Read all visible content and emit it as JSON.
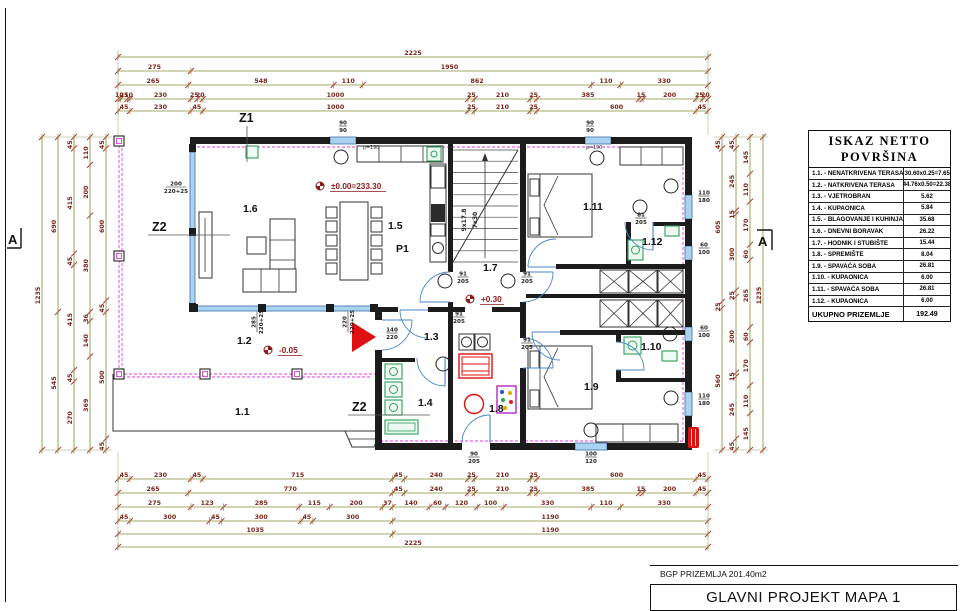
{
  "sheet": {
    "bgp_label": "BGP PRIZEMLJA 201.40m2",
    "title": "GLAVNI PROJEKT MAPA 1"
  },
  "area_table": {
    "title_line1": "ISKAZ NETTO",
    "title_line2": "POVRŠINA",
    "rows": [
      {
        "label": "1.1. - NENATKRIVENA TERASA",
        "value": "30.60x0.25=7.65"
      },
      {
        "label": "1.2. - NATKRIVENA TERASA",
        "value": "44.76x0.50=22.38"
      },
      {
        "label": "1.3. - VJETROBRAN",
        "value": "5.62"
      },
      {
        "label": "1.4. - KUPAONICA",
        "value": "5.84"
      },
      {
        "label": "1.5. - BLAGOVANJE I KUHINJA",
        "value": "35.68"
      },
      {
        "label": "1.6. - DNEVNI BORAVAK",
        "value": "26.22"
      },
      {
        "label": "1.7. - HODNIK I STUBIŠTE",
        "value": "15.44"
      },
      {
        "label": "1.8. - SPREMIŠTE",
        "value": "8.04"
      },
      {
        "label": "1.9. - SPAVAĆA SOBA",
        "value": "26.81"
      },
      {
        "label": "1.10. - KUPAONICA",
        "value": "6.00"
      },
      {
        "label": "1.11. - SPAVAĆA SOBA",
        "value": "26.81"
      },
      {
        "label": "1.12. - KUPAONICA",
        "value": "6.00"
      }
    ],
    "total": {
      "label": "UKUPNO PRIZEMLJE",
      "value": "192.49"
    }
  },
  "dimensions": {
    "top": [
      [
        2225
      ],
      [
        275,
        1950
      ],
      [
        265,
        548,
        110,
        862,
        110,
        330
      ],
      [
        10,
        25,
        10,
        230,
        25,
        20,
        1000,
        25,
        210,
        25,
        385,
        15,
        200,
        25,
        20
      ],
      [
        45,
        230,
        45,
        1000,
        25,
        210,
        25,
        600,
        45
      ]
    ],
    "bottom": [
      [
        45,
        230,
        45,
        715,
        45,
        240,
        25,
        210,
        25,
        600,
        45
      ],
      [
        265,
        770,
        45,
        240,
        25,
        210,
        25,
        385,
        15,
        200,
        45
      ],
      [
        275,
        123,
        285,
        115,
        200,
        37,
        140,
        60,
        120,
        100,
        330,
        110,
        330
      ],
      [
        45,
        300,
        45,
        300,
        45,
        300,
        1190
      ],
      [
        1035,
        1190
      ],
      [
        2225
      ]
    ],
    "left": [
      [
        1235
      ],
      [
        690,
        545
      ],
      [
        45,
        415,
        45,
        415,
        45,
        270
      ],
      [
        110,
        200,
        380,
        36,
        140,
        369
      ],
      [
        45,
        600,
        45,
        500,
        45
      ]
    ],
    "right": [
      [
        45,
        605,
        25,
        560
      ],
      [
        45,
        245,
        15,
        300,
        25,
        300,
        15,
        245,
        45
      ],
      [
        145,
        110,
        170,
        60,
        265,
        60,
        170,
        110,
        145
      ],
      [
        1235
      ]
    ]
  },
  "plan": {
    "section_marker": "A",
    "room_labels": [
      {
        "text": "1.1",
        "x": 235,
        "y": 415
      },
      {
        "text": "1.2",
        "x": 237,
        "y": 344
      },
      {
        "text": "1.3",
        "x": 424,
        "y": 340
      },
      {
        "text": "1.4",
        "x": 418,
        "y": 406
      },
      {
        "text": "1.5",
        "x": 388,
        "y": 229
      },
      {
        "text": "1.6",
        "x": 243,
        "y": 212
      },
      {
        "text": "1.7",
        "x": 483,
        "y": 271
      },
      {
        "text": "1.8",
        "x": 489,
        "y": 412
      },
      {
        "text": "1.9",
        "x": 584,
        "y": 390
      },
      {
        "text": "1.10",
        "x": 641,
        "y": 350
      },
      {
        "text": "1.11",
        "x": 583,
        "y": 210
      },
      {
        "text": "1.12",
        "x": 642,
        "y": 245
      },
      {
        "text": "P1",
        "x": 396,
        "y": 252
      }
    ],
    "zone_labels": [
      {
        "text": "Z1",
        "x": 239,
        "y": 122
      },
      {
        "text": "Z2",
        "x": 152,
        "y": 231
      },
      {
        "text": "Z2",
        "x": 352,
        "y": 411
      }
    ],
    "level_markers": [
      {
        "text": "±0.00=233.30",
        "x": 331,
        "y": 189,
        "sx": 320,
        "sy": 186
      },
      {
        "text": "+0.30",
        "x": 481,
        "y": 302,
        "sx": 470,
        "sy": 299
      },
      {
        "text": "-0.05",
        "x": 279,
        "y": 353,
        "sx": 268,
        "sy": 350
      }
    ],
    "stair_note": [
      "9x17.8",
      "7x30"
    ],
    "fraction_labels": [
      {
        "t": "90",
        "b": "90",
        "x": 343,
        "y": 126
      },
      {
        "t": "90",
        "b": "90",
        "x": 590,
        "y": 126
      },
      {
        "t": "110",
        "b": "180",
        "x": 704,
        "y": 196
      },
      {
        "t": "60",
        "b": "100",
        "x": 704,
        "y": 248
      },
      {
        "t": "60",
        "b": "100",
        "x": 704,
        "y": 331
      },
      {
        "t": "110",
        "b": "180",
        "x": 704,
        "y": 399
      },
      {
        "t": "200",
        "b": "220+25",
        "x": 176,
        "y": 187
      },
      {
        "t": "285",
        "b": "220+25",
        "x": 257,
        "y": 322,
        "rot": -90
      },
      {
        "t": "220",
        "b": "220+25",
        "x": 348,
        "y": 322,
        "rot": -90
      },
      {
        "t": "140",
        "b": "220",
        "x": 392,
        "y": 333
      },
      {
        "t": "100",
        "b": "120",
        "x": 591,
        "y": 457
      },
      {
        "t": "90",
        "b": "205",
        "x": 474,
        "y": 457
      },
      {
        "t": "91",
        "b": "205",
        "x": 463,
        "y": 277
      },
      {
        "t": "91",
        "b": "205",
        "x": 527,
        "y": 277
      },
      {
        "t": "91",
        "b": "205",
        "x": 527,
        "y": 343
      },
      {
        "t": "91",
        "b": "205",
        "x": 459,
        "y": 317
      },
      {
        "t": "81",
        "b": "205",
        "x": 641,
        "y": 218
      }
    ],
    "small_labels": [
      {
        "text": "p=190",
        "x": 363,
        "y": 149
      },
      {
        "text": "p=190",
        "x": 586,
        "y": 149
      }
    ]
  },
  "colors": {
    "dim_line": "#8a8a3c",
    "dim_text": "#7b2418",
    "tick": "#b03a3a",
    "wall": "#1c1c1c",
    "glass": "#a9d3ee",
    "glass_edge": "#3a6ea8",
    "magenta": "#e33ae3",
    "door": "#4a86c8",
    "green": "#2f9e5f",
    "red": "#e01010",
    "purple": "#b428cc",
    "level": "#8b1a1a"
  }
}
